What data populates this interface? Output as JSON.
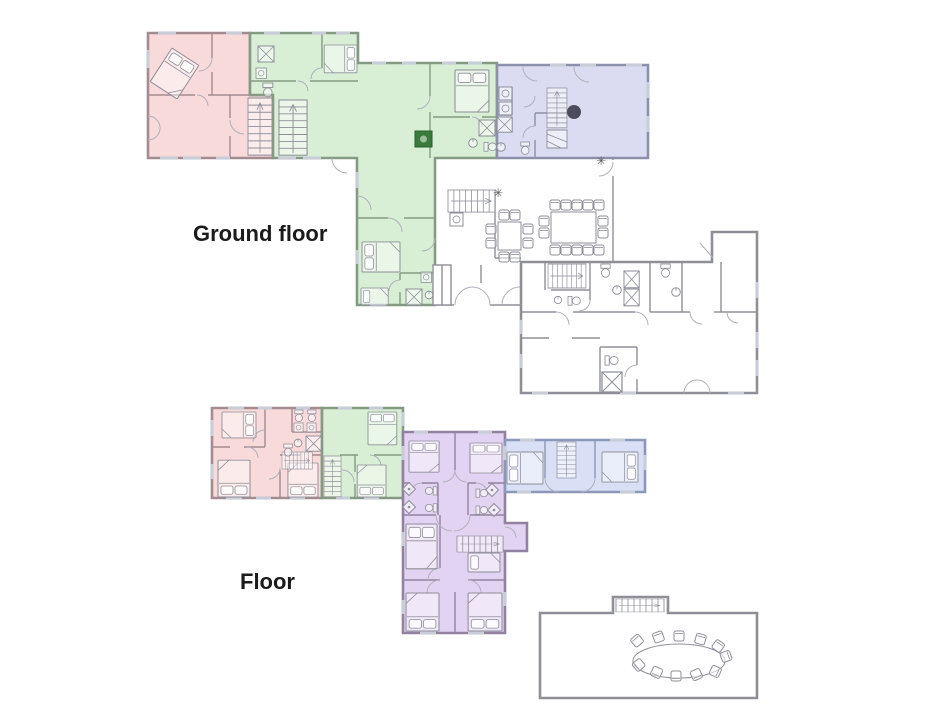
{
  "plans": [
    {
      "label": "Ground floor",
      "sections": [
        {
          "name": "west-apartment",
          "color_key": "pink"
        },
        {
          "name": "central-apartment",
          "color_key": "green"
        },
        {
          "name": "north-east-apartment",
          "color_key": "lavender"
        },
        {
          "name": "common-area-dining-and-service-wing",
          "color_key": "none"
        }
      ]
    },
    {
      "label": "Floor",
      "sections": [
        {
          "name": "west-apartment",
          "color_key": "pink"
        },
        {
          "name": "central-apartment",
          "color_key": "green"
        },
        {
          "name": "south-apartment",
          "color_key": "purple"
        },
        {
          "name": "east-apartment",
          "color_key": "blue"
        },
        {
          "name": "meeting-room",
          "color_key": "none"
        }
      ]
    }
  ],
  "symbols": {
    "vent": "✳"
  },
  "colors": {
    "background": "#ffffff",
    "label_text": "#1b1b1b",
    "pink": "#f8dada",
    "green": "#d8efd5",
    "lavender": "#dbdcf1",
    "purple": "#e3d3f2",
    "blue": "#d9e0f6",
    "wall": "#8f8f97",
    "wall_pink": "#a38b90",
    "wall_green": "#849a82",
    "wall_lavender": "#8d90ab",
    "wall_purple": "#92819f",
    "wall_blue": "#8d97b8",
    "furniture": "#8e8e99",
    "door": "#b0b0bc",
    "window_line": "#c9cdd8",
    "marker": "#4c4c5c",
    "stove": "#3a7a3a"
  }
}
